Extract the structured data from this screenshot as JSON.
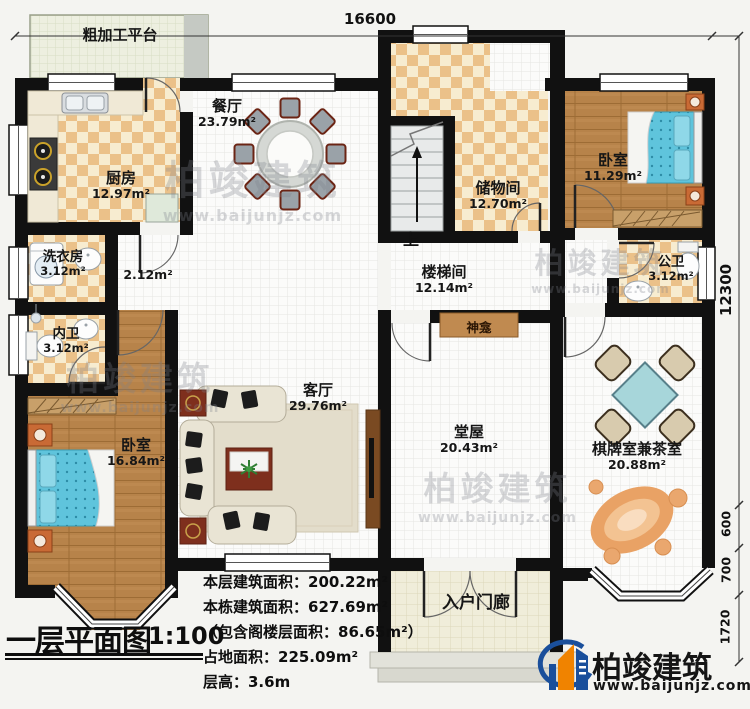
{
  "title": {
    "main": "一层平面图",
    "scale": "1:100"
  },
  "stats": [
    "本层建筑面积：200.22m²",
    "本栋建筑面积：627.69m²",
    "（包含阁楼层面积：86.65m²）",
    "占地面积：225.09m²",
    "层高：3.6m"
  ],
  "dimensions": {
    "top": "16600",
    "right": "12300",
    "seg1": "600",
    "seg2": "700",
    "seg3": "1720"
  },
  "rooms": [
    {
      "id": "platform",
      "name": "粗加工平台",
      "area": ""
    },
    {
      "id": "kitchen",
      "name": "厨房",
      "area": "12.97m²"
    },
    {
      "id": "dining",
      "name": "餐厅",
      "area": "23.79m²"
    },
    {
      "id": "storage",
      "name": "储物间",
      "area": "12.70m²"
    },
    {
      "id": "bedroom-ne",
      "name": "卧室",
      "area": "11.29m²"
    },
    {
      "id": "public-bath",
      "name": "公卫",
      "area": "3.12m²"
    },
    {
      "id": "laundry",
      "name": "洗衣房",
      "area": "3.12m²"
    },
    {
      "id": "hallway",
      "name": "",
      "area": "2.12m²"
    },
    {
      "id": "ensuite-bath",
      "name": "内卫",
      "area": "3.12m²"
    },
    {
      "id": "bedroom-sw",
      "name": "卧室",
      "area": "16.84m²"
    },
    {
      "id": "living",
      "name": "客厅",
      "area": "29.76m²"
    },
    {
      "id": "stair-hall",
      "name": "楼梯间",
      "area": "12.14m²"
    },
    {
      "id": "shrine",
      "name": "神龛",
      "area": ""
    },
    {
      "id": "main-hall",
      "name": "堂屋",
      "area": "20.43m²"
    },
    {
      "id": "chess-tea",
      "name": "棋牌室兼茶室",
      "area": "20.88m²"
    },
    {
      "id": "porch",
      "name": "入户门廊",
      "area": ""
    }
  ],
  "stair_up": "上",
  "logo": {
    "name": "柏竣建筑",
    "url": "www.baijunjz.com"
  },
  "watermark": {
    "name": "柏竣建筑",
    "url": "www.baijunjz.com"
  },
  "colors": {
    "wall": "#111111",
    "checker": "#ebc189",
    "wood": "#b7834a",
    "bed": "#5fc4dc",
    "logo_blue": "#1a4f9b",
    "logo_orange": "#f08300"
  }
}
